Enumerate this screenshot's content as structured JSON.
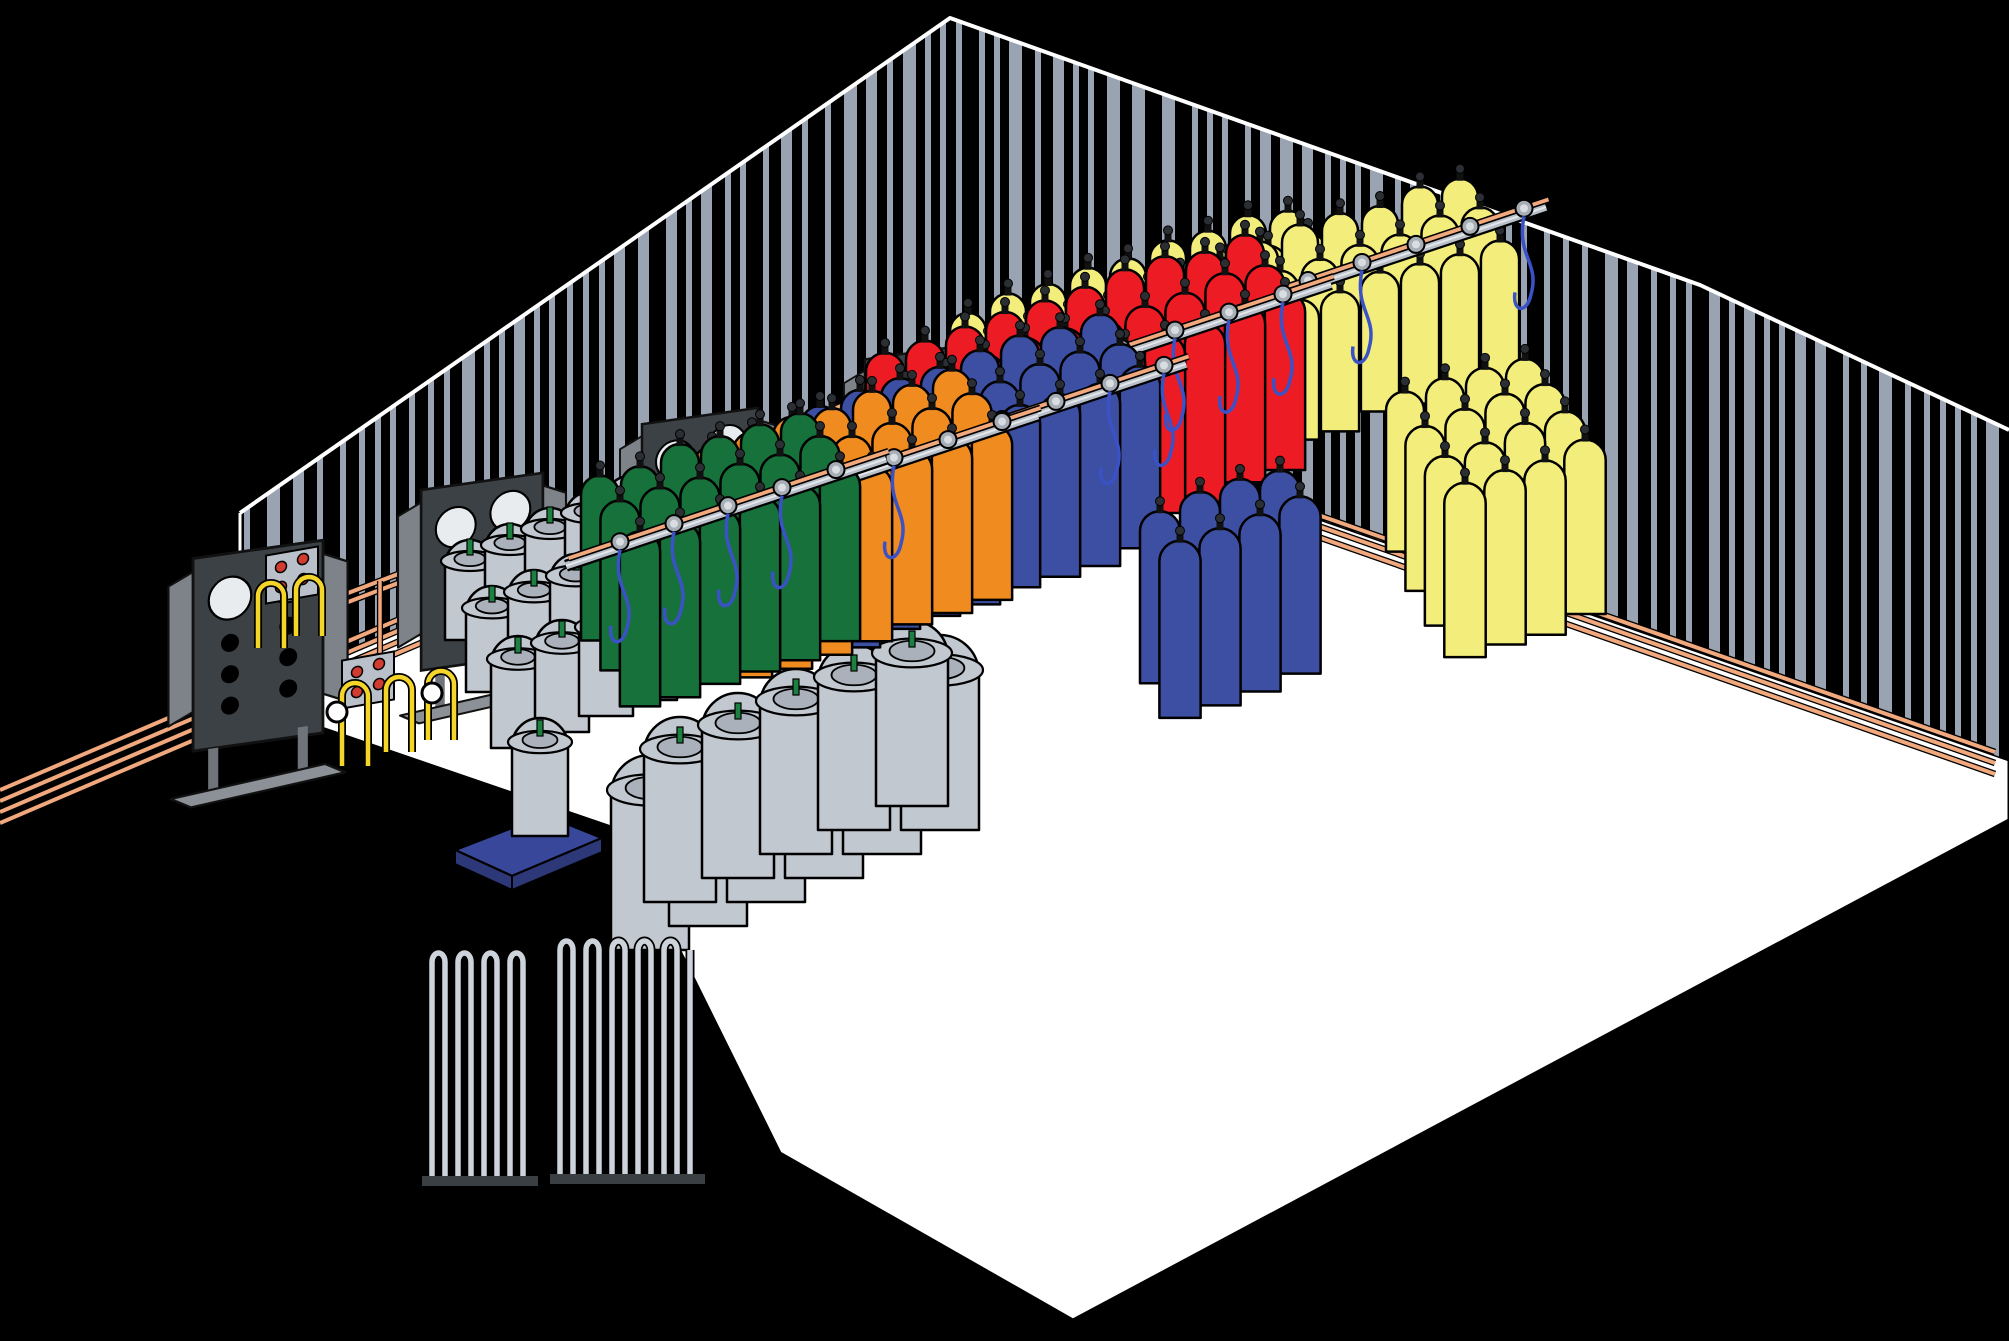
{
  "scene": {
    "width": 2009,
    "height": 1341,
    "background": "#000000",
    "floor_color": "#ffffff",
    "wall_stripe_color": "#99a3b1",
    "outline_color": "#000000"
  },
  "palette": {
    "copper_pipe": "#f0a87c",
    "rail_gray": "#b6bdc7",
    "carrier_red": "#9e2023",
    "hose_blue": "#3b52c7",
    "sign_plate": "#c5cbd2",
    "sign_text": "#1b1b1b",
    "panel_dark": "#3c4145",
    "dewar_gray": "#c2c8d0",
    "platform_blue": "#39479b",
    "pump_body": "#45525a",
    "pump_face_green": "#1d7c45",
    "pump_hose_blue": "#1f85c8"
  },
  "gas_colors": {
    "oxygen_green": "#17713a",
    "nitrogen_orange": "#ef8b1f",
    "nitrogen_blue": "#3c4fa2",
    "helium_red": "#ed1c24",
    "argon_co2_yellow": "#f3ee7c",
    "hydrogen_purple": "#a03a9e"
  },
  "supply_lines": {
    "colors": [
      "#f4edbb",
      "#ee3f96",
      "#f0a070",
      "#28a74b"
    ],
    "names": [
      "cream-line",
      "pink-line",
      "salmon-line",
      "green-line"
    ]
  },
  "storage_tanks": [
    {
      "id": "co2-tank",
      "label": "CO2"
    },
    {
      "id": "argon-tank",
      "label": "Argon"
    },
    {
      "id": "nitrogen-tank",
      "label": "Nitrogen"
    },
    {
      "id": "oxygen-tank",
      "label": "Oxygen"
    }
  ],
  "rack_signs": [
    {
      "label": "Oxygen",
      "x": 925,
      "y": 613,
      "w": 210
    },
    {
      "label": "Nitrogen",
      "x": 1058,
      "y": 550,
      "w": 230
    },
    {
      "label": "Helium",
      "x": 1158,
      "y": 485,
      "w": 185
    },
    {
      "label": "Carbon Dioxide",
      "x": 1265,
      "y": 425,
      "w": 330
    },
    {
      "label": "Argon",
      "x": 1363,
      "y": 350,
      "w": 185
    },
    {
      "label": "Hydrogen",
      "x": 1447,
      "y": 587,
      "w": 250
    },
    {
      "label": "Nitrogen",
      "x": 1212,
      "y": 722,
      "w": 230
    },
    {
      "label": "Oxygen",
      "x": 913,
      "y": 885,
      "w": 210
    },
    {
      "label": "Argon",
      "x": 1637,
      "y": 458,
      "w": 185
    }
  ],
  "cylinder_groups": [
    {
      "id": "co2-yellow-rear",
      "gas": "carbon dioxide",
      "color": "#f3ee7c",
      "x": 968,
      "y": 460,
      "cols": 9,
      "rows": 3,
      "w": 36,
      "h": 150,
      "rail": "ne"
    },
    {
      "id": "argon-yellow-top",
      "gas": "argon",
      "color": "#f3ee7c",
      "x": 1180,
      "y": 400,
      "cols": 8,
      "rows": 3,
      "w": 36,
      "h": 132,
      "rail": "ne"
    },
    {
      "id": "helium-red",
      "gas": "helium",
      "color": "#ed1c24",
      "x": 885,
      "y": 520,
      "cols": 10,
      "rows": 3,
      "w": 38,
      "h": 168,
      "rail": "ne"
    },
    {
      "id": "nitrogen-blue-rear",
      "gas": "nitrogen",
      "color": "#3c4fa2",
      "x": 820,
      "y": 575,
      "cols": 8,
      "rows": 3,
      "w": 38,
      "h": 172,
      "rail": "ne"
    },
    {
      "id": "hydrogen-yellow-rear",
      "gas": "argon",
      "color": "#f3ee7c",
      "x": 1405,
      "y": 555,
      "cols": 4,
      "rows": 4,
      "w": 38,
      "h": 160,
      "rail": "none"
    },
    {
      "id": "orange-rear",
      "gas": "nitrogen",
      "color": "#ef8b1f",
      "x": 712,
      "y": 610,
      "cols": 7,
      "rows": 3,
      "w": 38,
      "h": 165,
      "rail": "ne"
    },
    {
      "id": "green-rear",
      "gas": "oxygen",
      "color": "#17713a",
      "x": 600,
      "y": 640,
      "cols": 6,
      "rows": 3,
      "w": 38,
      "h": 165,
      "rail": "ne"
    },
    {
      "id": "nitrogen-blue-mid",
      "gas": "nitrogen",
      "color": "#3c4fa2",
      "x": 1160,
      "y": 680,
      "cols": 4,
      "rows": 2,
      "w": 40,
      "h": 172,
      "rail": "none"
    },
    {
      "id": "argon-yellow-right",
      "gas": "argon",
      "color": "#f3ee7c",
      "x": 1595,
      "y": 690,
      "cols": 7,
      "rows": 4,
      "w": 40,
      "h": 180,
      "rail": "se"
    },
    {
      "id": "hydrogen-purple",
      "gas": "hydrogen",
      "color": "#a03a9e",
      "x": 1095,
      "y": 705,
      "cols": 9,
      "rows": 4,
      "w": 42,
      "h": 185,
      "rail": "ne"
    },
    {
      "id": "purple-right",
      "gas": "hydrogen",
      "color": "#a03a9e",
      "x": 1660,
      "y": 880,
      "cols": 8,
      "rows": 4,
      "w": 44,
      "h": 195,
      "rail": "se"
    },
    {
      "id": "orange-front",
      "gas": "nitrogen",
      "color": "#ef8b1f",
      "x": 1012,
      "y": 840,
      "cols": 9,
      "rows": 5,
      "w": 42,
      "h": 175,
      "rail": "ne"
    },
    {
      "id": "green-front",
      "gas": "oxygen",
      "color": "#17713a",
      "x": 665,
      "y": 975,
      "cols": 11,
      "rows": 6,
      "w": 42,
      "h": 185,
      "rail": "ne"
    }
  ],
  "equipment": {
    "manifold_panel_count": 6,
    "conveyor_carrier_count": 9,
    "vaporizer_banks": 2,
    "dewar_cluster": "gray liquid cylinders",
    "pump": "cryogenic transfer pump"
  }
}
